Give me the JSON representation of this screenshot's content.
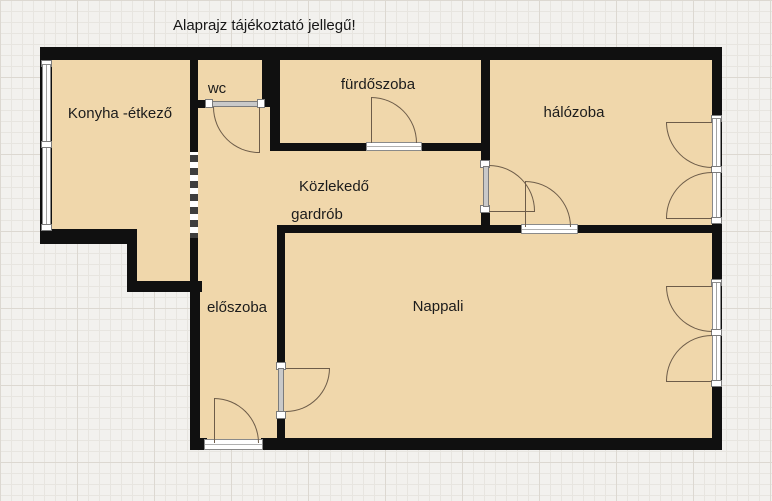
{
  "title": "Alaprajz tájékoztató jellegű!",
  "rooms": {
    "kitchen": "Konyha -étkező",
    "wc": "wc",
    "bathroom": "fürdőszoba",
    "bedroom": "hálózoba",
    "hallway": "Közlekedő",
    "wardrobe": "gardrób",
    "entry": "előszoba",
    "living": "Nappali"
  },
  "colors": {
    "wall": "#101010",
    "room_fill": "#f0d7ab",
    "background": "#f2f1ee",
    "grid_line": "#e7e5e0",
    "grid_line_major": "#dcd8d1",
    "door_arc": "#6d5c49",
    "door_bar": "#c9c9c9",
    "symbol_outline": "#7b7b7b"
  }
}
